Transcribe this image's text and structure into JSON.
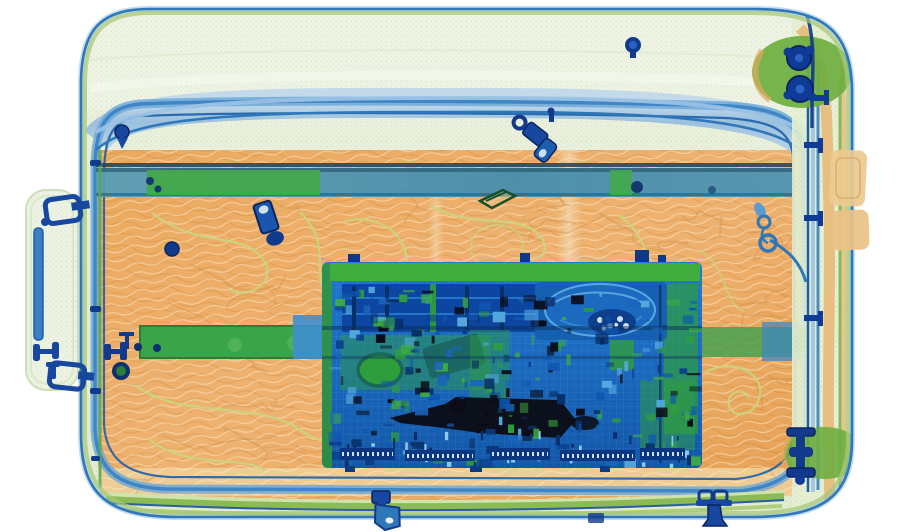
{
  "scene": {
    "title": "Security X-ray scan of a suitcase containing a laptop",
    "background_color": "#ffffff",
    "palette": {
      "organic_orange": "#e9aa60",
      "case_fabric_green": "#e7efda",
      "light_metal_green": "#3fa84a",
      "metal_blue": "#1b72c8",
      "dense_navy": "#123a8c",
      "very_dense_black": "#0c0c14",
      "zipper_blue": "#4a8cc8"
    },
    "objects": [
      {
        "id": "suitcase-body",
        "label": "Soft-shell suitcase, side view",
        "color": "#e7efda"
      },
      {
        "id": "zipper-loop",
        "label": "Main zipper track running around the case",
        "color": "#3e86c6"
      },
      {
        "id": "carry-handle",
        "label": "Carry handle with metal rod and brackets (left)",
        "color": "#3c7fc0"
      },
      {
        "id": "telescopic-handle-upper",
        "label": "Telescopic handle tube, upper",
        "color": "#44a84c"
      },
      {
        "id": "telescopic-handle-lower",
        "label": "Telescopic handle tube, lower",
        "color": "#3aa44a"
      },
      {
        "id": "laptop-motherboard",
        "label": "Laptop motherboard with dense electronics",
        "color": "#1b72c8"
      },
      {
        "id": "ram-modules",
        "label": "RAM modules",
        "color": "#0c46a0"
      },
      {
        "id": "hard-drive",
        "label": "Hard disk drive platter",
        "color": "#1560b0"
      },
      {
        "id": "battery-dense-mass",
        "label": "Very dense mass (battery / metal block)",
        "color": "#0c0c14"
      },
      {
        "id": "wheel-top-right",
        "label": "Corner wheel with metal bearings, top right",
        "color": "#6fae41"
      },
      {
        "id": "wheel-bottom-right",
        "label": "Corner wheel with axle bolt, bottom right",
        "color": "#6fae41"
      },
      {
        "id": "zipper-pull-top",
        "label": "Zipper slider and pull tab, top",
        "color": "#17479e"
      },
      {
        "id": "zipper-pull-bottom-center",
        "label": "Zipper slider and pull tab, bottom center",
        "color": "#17479e"
      },
      {
        "id": "zipper-pull-bottom-right",
        "label": "Zipper slider and pull tab, bottom right",
        "color": "#17479e"
      },
      {
        "id": "zipper-rings-right",
        "label": "Zipper rings on cord, right side",
        "color": "#2e77b8"
      },
      {
        "id": "metal-clip",
        "label": "Small metal clip with strap blob",
        "color": "#123a8c"
      },
      {
        "id": "rivet-top-right",
        "label": "Metal rivet on top edge",
        "color": "#123a8c"
      },
      {
        "id": "buckle-frame",
        "label": "Plastic buckle frame outline",
        "color": "#14502c"
      },
      {
        "id": "clothing-contents",
        "label": "Folded clothing and organic contents",
        "color": "#e9aa60"
      },
      {
        "id": "cables",
        "label": "Thin cords among the clothing",
        "color": "#c2d37e"
      }
    ]
  }
}
